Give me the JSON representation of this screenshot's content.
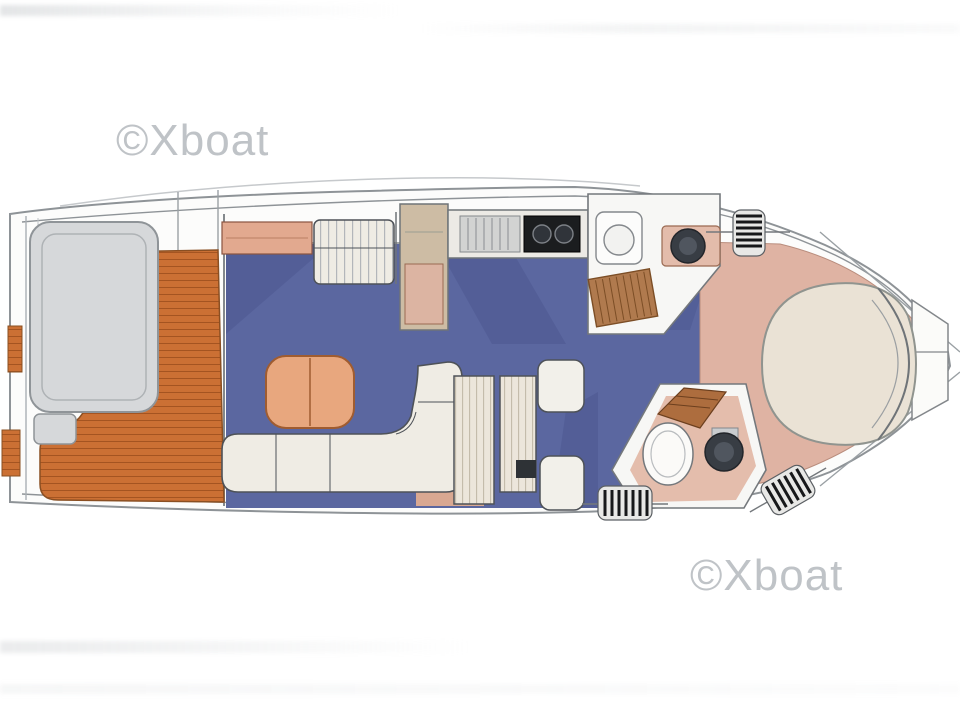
{
  "page": {
    "background_color": "#ffffff"
  },
  "watermarks": [
    {
      "id": "watermark-top-left",
      "text": "©Xboat",
      "color": "#aeb3b8"
    },
    {
      "id": "watermark-bottom-right",
      "text": "©Xboat",
      "color": "#aeb3b8"
    }
  ],
  "plan": {
    "type": "yacht-interior-deck-plan",
    "orientation": "bow-right",
    "colors": {
      "hull": "#fcfcfb",
      "outline": "#8e9397",
      "teak": "#cb7034",
      "teak_line": "#9e4f1d",
      "carpet": "#5b67a0",
      "carpet_shade": "#4c5890",
      "upholstery": "#efece4",
      "upholstery_line": "#4e5258",
      "counter": "#cdbca4",
      "salmon": "#e2a98f",
      "salmon_floor": "#e4bdac",
      "bed": "#eae2d5",
      "bed_surround": "#dfb3a3",
      "seat_gray": "#d6d8da",
      "stove": "#1b1d1f",
      "wood_step": "#ad6d3e",
      "fitting": "#17181a",
      "watermark": "#aeb3b8"
    },
    "areas": [
      {
        "name": "swim-platform"
      },
      {
        "name": "aft-cockpit-teak-deck"
      },
      {
        "name": "cockpit-seat"
      },
      {
        "name": "saloon-carpet"
      },
      {
        "name": "port-sideboard"
      },
      {
        "name": "port-settee"
      },
      {
        "name": "galley-counter"
      },
      {
        "name": "galley-sink"
      },
      {
        "name": "galley-stove"
      },
      {
        "name": "saloon-table"
      },
      {
        "name": "saloon-sofa"
      },
      {
        "name": "mid-cabin-berth"
      },
      {
        "name": "mid-cabin-seats"
      },
      {
        "name": "head-compartment-upper"
      },
      {
        "name": "head-compartment-lower"
      },
      {
        "name": "companionway-steps"
      },
      {
        "name": "deck-fittings"
      },
      {
        "name": "owner-cabin-bed"
      },
      {
        "name": "bow-lockers"
      }
    ]
  }
}
